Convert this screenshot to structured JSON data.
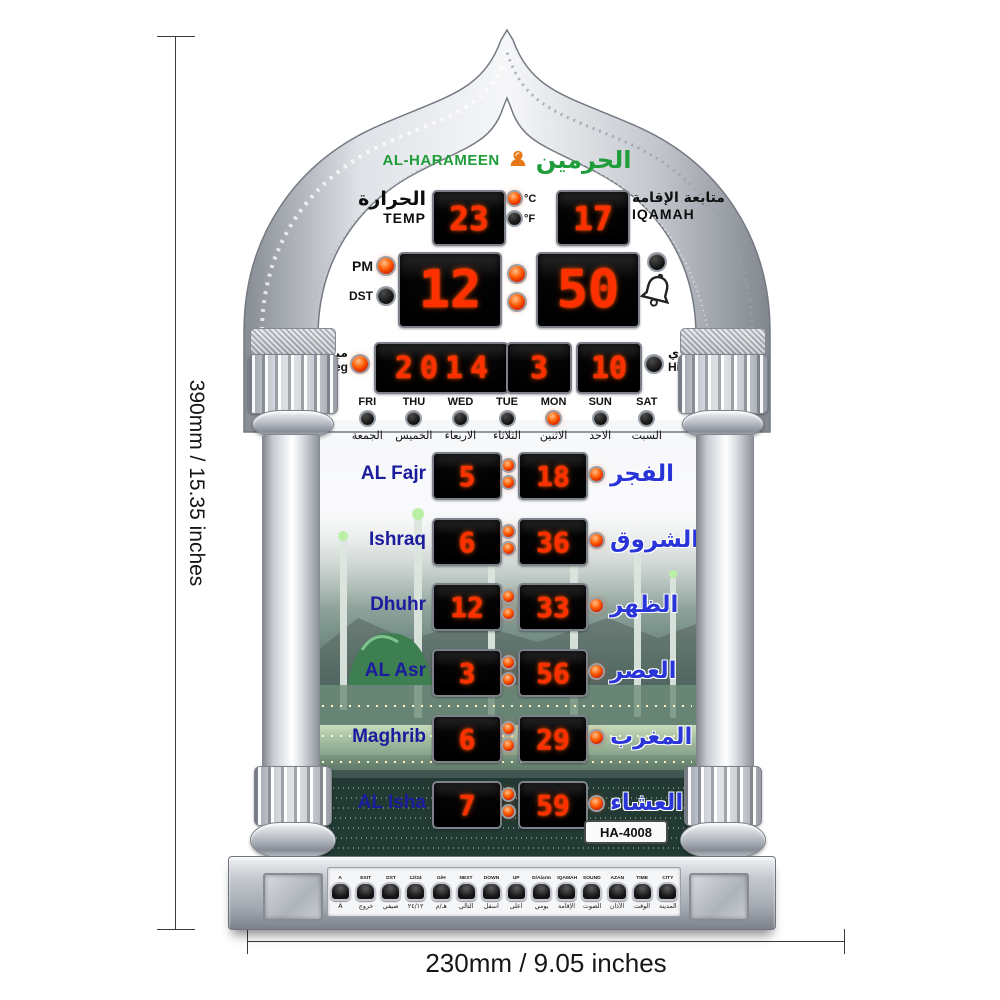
{
  "brand": {
    "name_en": "AL-HARAMEEN",
    "name_ar": "الحرمين"
  },
  "temperature": {
    "label_ar": "الحرارة",
    "label_en": "TEMP",
    "value": "23",
    "celsius": "°C",
    "fahrenheit": "°F"
  },
  "iqamah_monitor": {
    "label_ar": "متابعة الإقامة",
    "label_en": "IQAMAH",
    "value": "17"
  },
  "clock": {
    "pm": "PM",
    "dst": "DST",
    "hour": "12",
    "minute": "50"
  },
  "date": {
    "greg_label_ar": "ميلادي",
    "greg_label_en": "Greg",
    "year": "2014",
    "month": "3",
    "day": "10",
    "hijri_label_ar": "هجري",
    "hijri_label_en": "Hijri"
  },
  "days": [
    {
      "en": "FRI",
      "ar": "الجمعة"
    },
    {
      "en": "THU",
      "ar": "الخميس"
    },
    {
      "en": "WED",
      "ar": "الاربعاء"
    },
    {
      "en": "TUE",
      "ar": "الثلاثاء"
    },
    {
      "en": "MON",
      "ar": "الاثنين"
    },
    {
      "en": "SUN",
      "ar": "الاحد"
    },
    {
      "en": "SAT",
      "ar": "السبت"
    }
  ],
  "active_day": "MON",
  "prayers": [
    {
      "en": "AL Fajr",
      "hour": "5",
      "minute": "18",
      "ar": "الفجر"
    },
    {
      "en": "Ishraq",
      "hour": "6",
      "minute": "36",
      "ar": "الشروق"
    },
    {
      "en": "Dhuhr",
      "hour": "12",
      "minute": "33",
      "ar": "الظهر"
    },
    {
      "en": "AL Asr",
      "hour": "3",
      "minute": "56",
      "ar": "العصر"
    },
    {
      "en": "Maghrib",
      "hour": "6",
      "minute": "29",
      "ar": "المغرب"
    },
    {
      "en": "AL Isha",
      "hour": "7",
      "minute": "59",
      "ar": "العشاء"
    }
  ],
  "model": "HA-4008",
  "buttons": [
    {
      "en": "A",
      "ar": "A"
    },
    {
      "en": "EXIT",
      "ar": "خروج"
    },
    {
      "en": "DST",
      "ar": "صيفي"
    },
    {
      "en": "12/24",
      "ar": "٢٤/١٢"
    },
    {
      "en": "G/H",
      "ar": "هـ/م"
    },
    {
      "en": "NEXT",
      "ar": "التالي"
    },
    {
      "en": "DOWN",
      "ar": "اسفل"
    },
    {
      "en": "UP",
      "ar": "اعلى"
    },
    {
      "en": "D/Alarm",
      "ar": "يومي"
    },
    {
      "en": "IQAMAH",
      "ar": "الإقامة"
    },
    {
      "en": "SOUND",
      "ar": "الصوت"
    },
    {
      "en": "AZAN",
      "ar": "الآذان"
    },
    {
      "en": "TIME",
      "ar": "الوقت"
    },
    {
      "en": "CITY",
      "ar": "المدينة"
    }
  ],
  "dimensions": {
    "height": "390mm / 15.35 inches",
    "width": "230mm / 9.05 inches"
  },
  "colors": {
    "led_red": "#ff3000",
    "brand_green": "#1f9d3a",
    "logo_orange": "#e87817",
    "label_blue": "#2a35d8",
    "label_navy": "#1b1b9e",
    "silver": "#c9ccd2"
  }
}
